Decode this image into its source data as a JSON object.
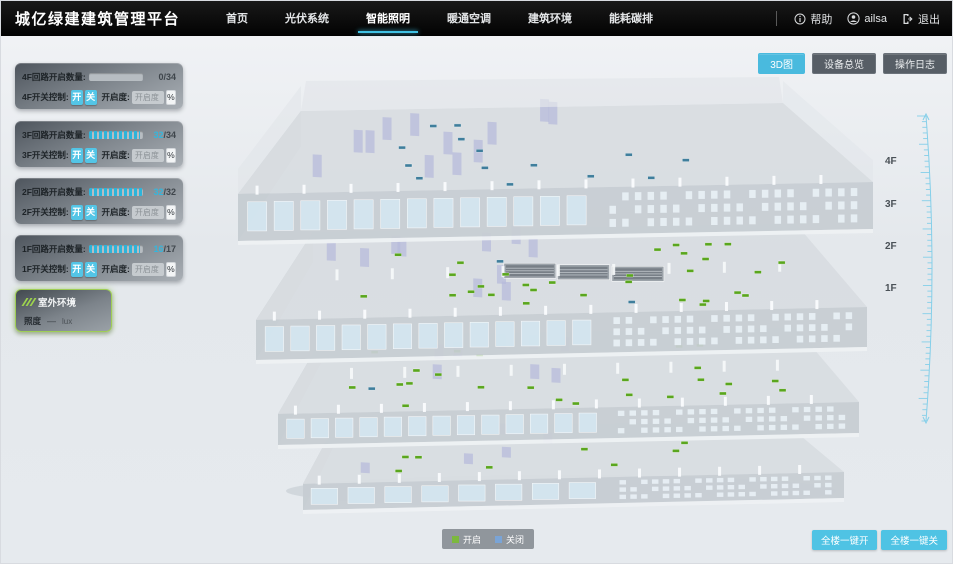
{
  "header": {
    "title": "城亿绿建建筑管理平台",
    "nav": [
      {
        "label": "首页",
        "active": false
      },
      {
        "label": "光伏系统",
        "active": false
      },
      {
        "label": "智能照明",
        "active": true
      },
      {
        "label": "暖通空调",
        "active": false
      },
      {
        "label": "建筑环境",
        "active": false
      },
      {
        "label": "能耗碳排",
        "active": false
      }
    ],
    "help": "帮助",
    "username": "ailsa",
    "logout": "退出"
  },
  "view_toolbar": {
    "buttons": [
      {
        "label": "3D图",
        "active": true
      },
      {
        "label": "设备总览",
        "active": false
      },
      {
        "label": "操作日志",
        "active": false
      }
    ]
  },
  "floor_panels": [
    {
      "floor": "4F",
      "circuit_label": "4F回路开启数量:",
      "open": 0,
      "total": 34,
      "open_display": "0",
      "total_display": "/34",
      "switch_label": "4F开关控制:",
      "on_label": "开",
      "off_label": "关",
      "dim_label": "开启度:",
      "dim_placeholder": "开启度",
      "percent_label": "%"
    },
    {
      "floor": "3F",
      "circuit_label": "3F回路开启数量:",
      "open": 32,
      "total": 34,
      "open_display": "32",
      "total_display": "/34",
      "switch_label": "3F开关控制:",
      "on_label": "开",
      "off_label": "关",
      "dim_label": "开启度:",
      "dim_placeholder": "开启度",
      "percent_label": "%"
    },
    {
      "floor": "2F",
      "circuit_label": "2F回路开启数量:",
      "open": 32,
      "total": 32,
      "open_display": "32",
      "total_display": "/32",
      "switch_label": "2F开关控制:",
      "on_label": "开",
      "off_label": "关",
      "dim_label": "开启度:",
      "dim_placeholder": "开启度",
      "percent_label": "%"
    },
    {
      "floor": "1F",
      "circuit_label": "1F回路开启数量:",
      "open": 16,
      "total": 17,
      "open_display": "16",
      "total_display": "/17",
      "switch_label": "1F开关控制:",
      "on_label": "开",
      "off_label": "关",
      "dim_label": "开启度:",
      "dim_placeholder": "开启度",
      "percent_label": "%"
    }
  ],
  "outdoor_panel": {
    "title": "室外环境",
    "metric_label": "照度",
    "metric_value": "—",
    "metric_unit": "lux"
  },
  "scene": {
    "floor_labels": [
      "4F",
      "3F",
      "2F",
      "1F"
    ],
    "floors": [
      {
        "name": "4F",
        "marker_color": "#3f7e9c",
        "marker_count": 14,
        "alt_marker_color": "#3f7e9c",
        "alt_marker_count": 0
      },
      {
        "name": "3F",
        "marker_color": "#5aa61e",
        "marker_count": 30,
        "alt_marker_color": "#3f7e9c",
        "alt_marker_count": 2
      },
      {
        "name": "2F",
        "marker_color": "#5aa61e",
        "marker_count": 24,
        "alt_marker_color": "#3f7e9c",
        "alt_marker_count": 1
      },
      {
        "name": "1F",
        "marker_color": "#5aa61e",
        "marker_count": 8,
        "alt_marker_color": "#3f7e9c",
        "alt_marker_count": 0
      }
    ]
  },
  "legend": {
    "items": [
      {
        "label": "开启",
        "color": "#7cb83e"
      },
      {
        "label": "关闭",
        "color": "#7aa4d6"
      }
    ]
  },
  "bottom_actions": [
    {
      "label": "全楼一键开"
    },
    {
      "label": "全楼一键关"
    }
  ],
  "colors": {
    "accent": "#45bfe2",
    "count_open": "#35b6dc",
    "count_zero": "#3f464c",
    "ruler": "#85cfe9"
  }
}
